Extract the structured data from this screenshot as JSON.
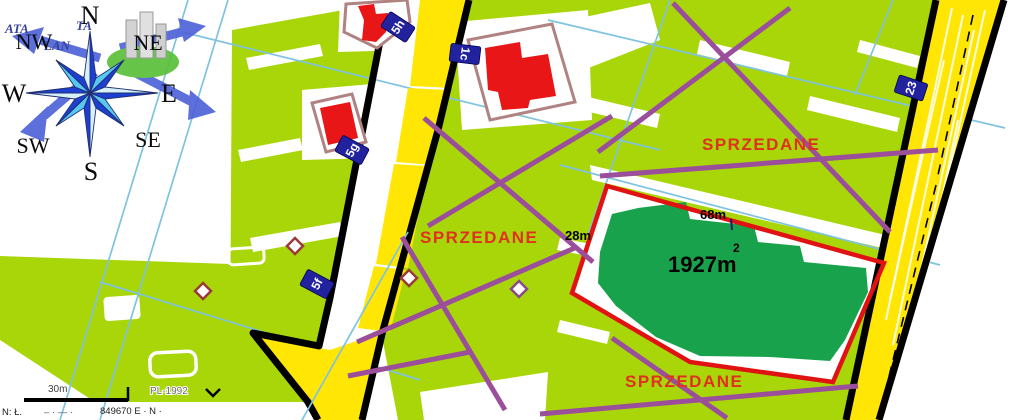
{
  "compass": {
    "n": "N",
    "ne": "NE",
    "e": "E",
    "se": "SE",
    "s": "S",
    "sw": "SW",
    "w": "W",
    "nw": "NW"
  },
  "watermark": {
    "fragment_left": "ATA",
    "fragment_right": "TA",
    "fragment_bottom": "LAN"
  },
  "parcels": {
    "badges": {
      "b5h": "5h",
      "b1c": "1c",
      "b5g": "5g",
      "b5f": "5f",
      "b23": "23"
    },
    "sold_top": "SPRZEDANE",
    "sold_middle": "SPRZEDANE",
    "sold_bottom": "SPRZEDANE"
  },
  "highlight_plot": {
    "area": "1927m",
    "area_exp": "2",
    "width_label": "68m",
    "depth_label": "28m"
  },
  "scalebar": {
    "distance": "30m",
    "crs": "PL-1992"
  },
  "footer": {
    "left": "N: Ł.",
    "mid": "– · — ·",
    "right": "849670 E · N ·"
  },
  "colors": {
    "parcel_green": "#a9d608",
    "sold_plot_green": "#18a24c",
    "road_yellow": "#ffe605",
    "sold_text_red": "#e0301e",
    "highlight_border_red": "#e01212",
    "building_red": "#e81616",
    "plot_outline_brown": "#b08282",
    "badge_navy": "#22229e",
    "cadastral_cyan": "#7fc3e0",
    "cross_purple": "#9b4f9b",
    "compass_dark_blue": "#1d3fd2",
    "compass_light_blue": "#58c8f0"
  }
}
